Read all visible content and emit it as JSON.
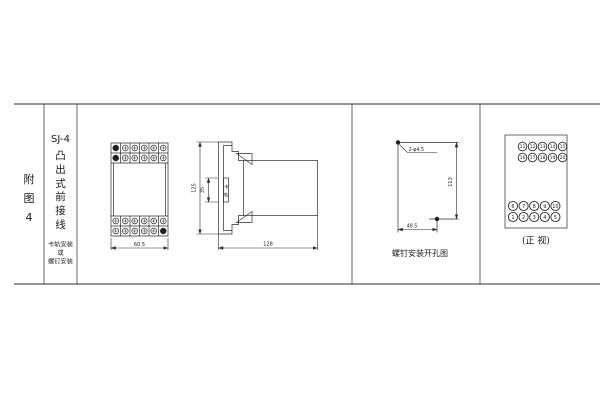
{
  "page": {
    "background": "#ffffff",
    "line_color": "#2b2b2b"
  },
  "index_cell": {
    "chars": [
      "附",
      "图",
      "4"
    ]
  },
  "model_cell": {
    "model": "SJ-4",
    "style_chars": [
      "凸",
      "出",
      "式",
      "前",
      "接",
      "线"
    ],
    "mount_lines": [
      "卡轨安装",
      "或",
      "螺钉安装"
    ]
  },
  "front_view": {
    "width_dim": "60.5"
  },
  "side_view": {
    "height_dim": "125",
    "rail_height_dim": "35",
    "rail_chars": [
      "卡",
      "轨"
    ],
    "depth_dim": "128"
  },
  "drill_plan": {
    "holes_label": "2-φ4.5",
    "height_dim": "113",
    "width_dim": "48.5",
    "caption": "螺钉安装开孔图"
  },
  "terminal_view": {
    "caption": "(正 视)",
    "top_rows": [
      [
        "11",
        "12",
        "13",
        "14",
        "15"
      ],
      [
        "16",
        "17",
        "18",
        "19",
        "20"
      ]
    ],
    "bottom_rows": [
      [
        "6",
        "7",
        "8",
        "9",
        "10"
      ],
      [
        "1",
        "2",
        "3",
        "4",
        "5"
      ]
    ]
  }
}
